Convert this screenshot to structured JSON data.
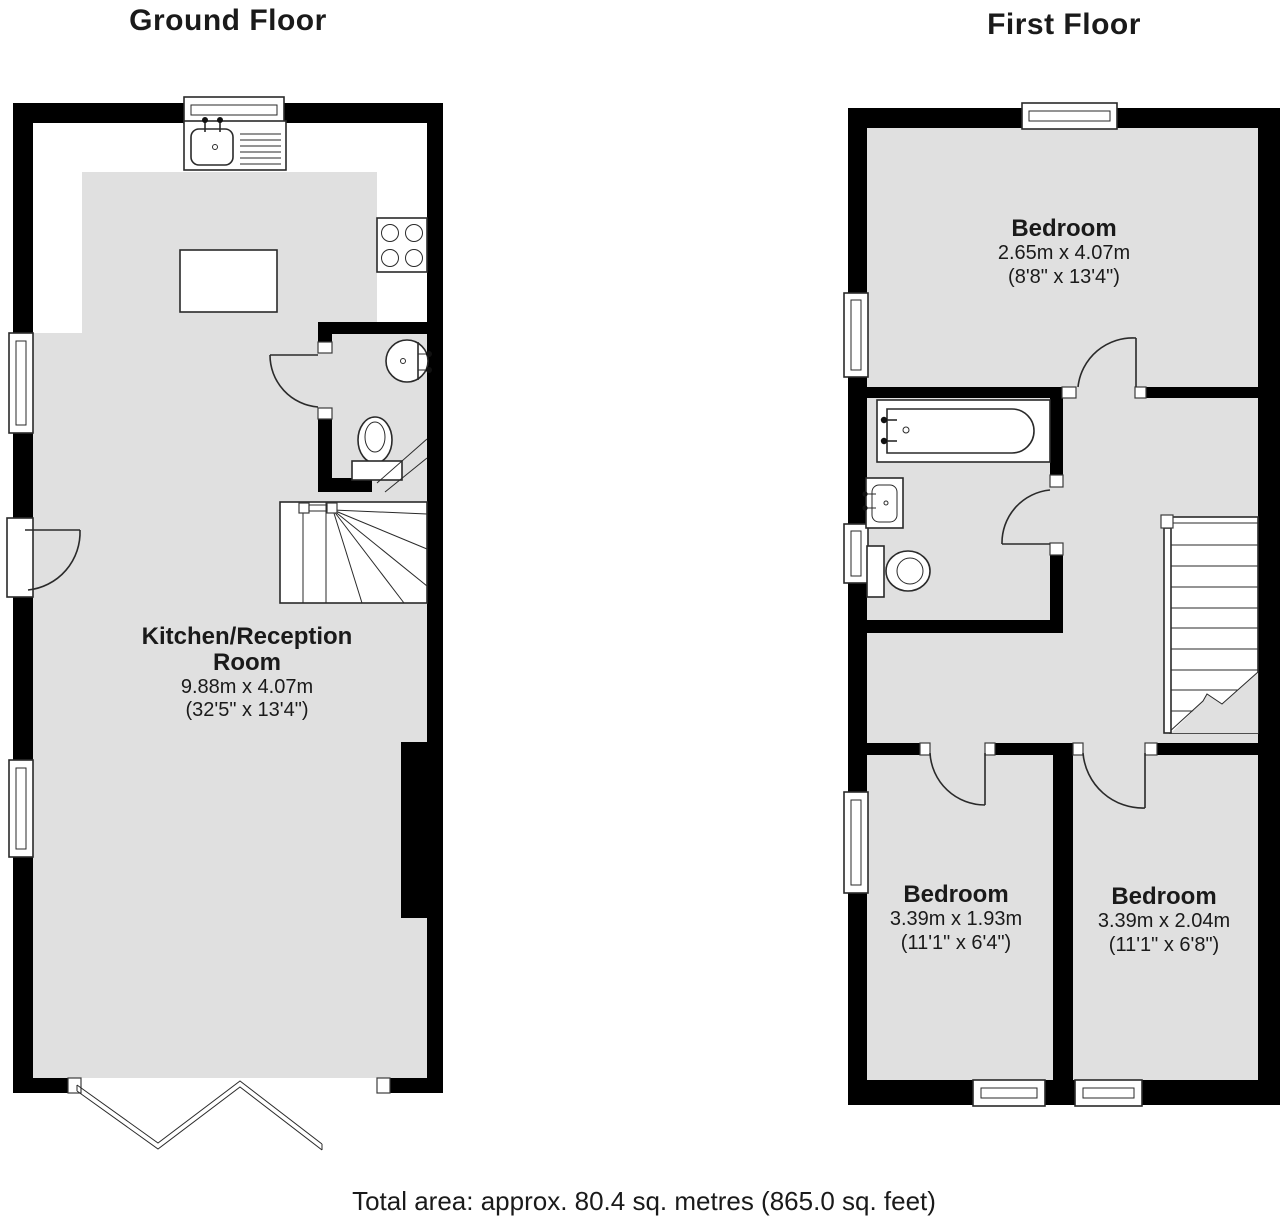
{
  "titles": {
    "ground": "Ground Floor",
    "first": "First Floor"
  },
  "rooms": {
    "kitchen": {
      "name": "Kitchen/Reception Room",
      "metric": "9.88m x 4.07m",
      "imperial": "(32'5\" x 13'4\")"
    },
    "bedroom_top": {
      "name": "Bedroom",
      "metric": "2.65m x 4.07m",
      "imperial": "(8'8\" x 13'4\")"
    },
    "bedroom_left": {
      "name": "Bedroom",
      "metric": "3.39m x 1.93m",
      "imperial": "(11'1\" x 6'4\")"
    },
    "bedroom_right": {
      "name": "Bedroom",
      "metric": "3.39m x 2.04m",
      "imperial": "(11'1\" x 6'8\")"
    }
  },
  "footer": {
    "total_area": "Total area: approx. 80.4 sq. metres (865.0 sq. feet)"
  },
  "colors": {
    "wall": "#000000",
    "floor": "#e0e0e0",
    "line": "#2a2a2a",
    "text": "#1a1a1a"
  },
  "icons": {
    "fixtures": [
      "window-icon",
      "door-arc-icon",
      "bifold-doors-icon",
      "kitchen-sink-icon",
      "stove-icon",
      "kitchen-island",
      "wc-basin-icon",
      "toilet-icon",
      "bathtub-icon",
      "bathroom-sink-icon",
      "staircase-icon"
    ]
  }
}
